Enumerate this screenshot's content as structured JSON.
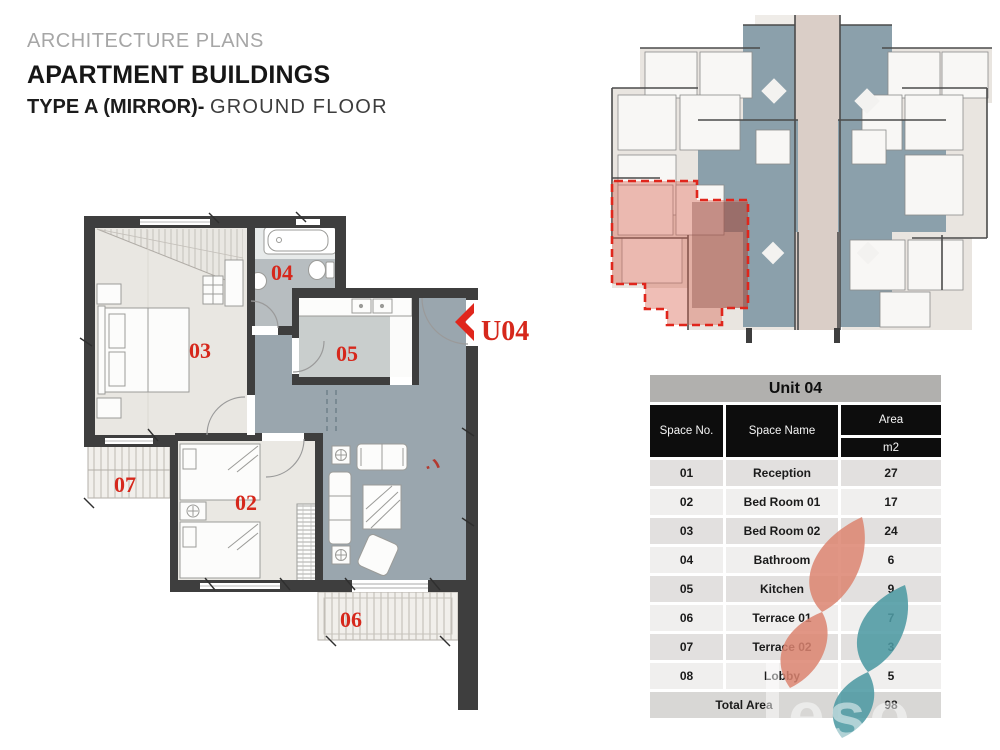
{
  "header": {
    "eyebrow": "ARCHITECTURE PLANS",
    "title": "APARTMENT BUILDINGS",
    "subtitle_bold": "TYPE A (MIRROR)-",
    "subtitle_light": " GROUND FLOOR"
  },
  "plan": {
    "entry_label": "U04",
    "reception_mark": "٠١",
    "labels": {
      "bedroom1": "02",
      "bedroom2": "03",
      "bathroom": "04",
      "kitchen": "05",
      "terrace1": "06",
      "terrace2": "07"
    }
  },
  "table": {
    "title": "Unit 04",
    "columns": {
      "space_no": "Space No.",
      "space_name": "Space Name",
      "area": "Area",
      "area_unit": "m2"
    },
    "rows": [
      {
        "no": "01",
        "name": "Reception",
        "area": "27"
      },
      {
        "no": "02",
        "name": "Bed Room 01",
        "area": "17"
      },
      {
        "no": "03",
        "name": "Bed Room 02",
        "area": "24"
      },
      {
        "no": "04",
        "name": "Bathroom",
        "area": "6"
      },
      {
        "no": "05",
        "name": "Kitchen",
        "area": "9"
      },
      {
        "no": "06",
        "name": "Terrace 01",
        "area": "7"
      },
      {
        "no": "07",
        "name": "Terrace 02",
        "area": "3"
      },
      {
        "no": "08",
        "name": "Lobby",
        "area": "5"
      }
    ],
    "total_label": "Total Area",
    "total_value": "98"
  },
  "watermark": {
    "text": "eso"
  },
  "colors": {
    "accent_red": "#d6281c",
    "wall_dark": "#3e3e3e",
    "reception_gray": "#9aa6ae",
    "bedroom_beige": "#eae8e3",
    "bathroom_gray": "#b7bdc0",
    "overview_steel": "#8ba0ab",
    "highlight_salmon": "#d96452",
    "ribbon_orange": "#dc8470",
    "ribbon_teal": "#4d9aa3"
  }
}
